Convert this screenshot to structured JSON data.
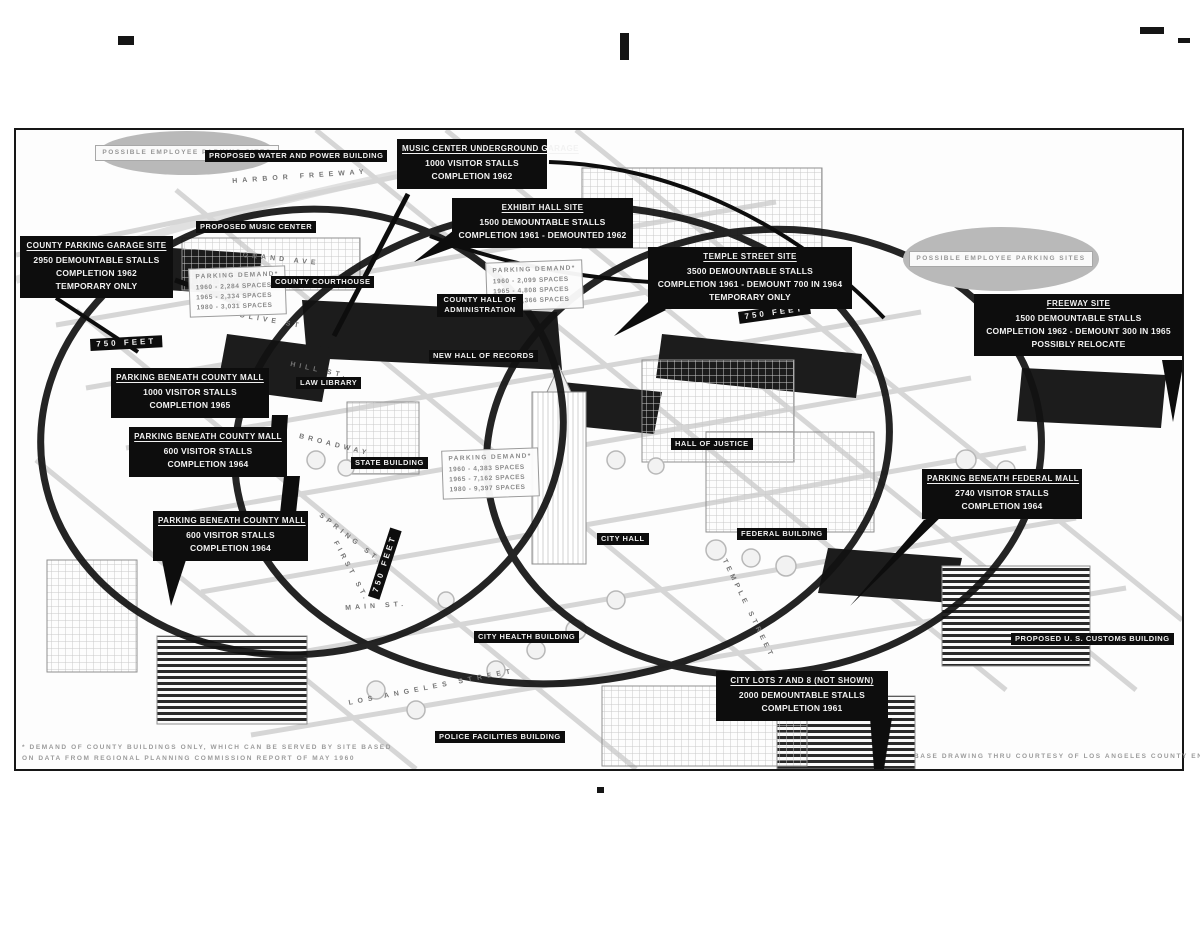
{
  "callouts": [
    {
      "id": "music-center-garage",
      "title": "MUSIC CENTER UNDERGROUND GARAGE",
      "line1": "1000 VISITOR STALLS",
      "line2": "COMPLETION 1962"
    },
    {
      "id": "exhibit-hall",
      "title": "EXHIBIT HALL SITE",
      "line1": "1500 DEMOUNTABLE STALLS",
      "line2": "COMPLETION 1961 - DEMOUNTED 1962"
    },
    {
      "id": "county-parking-garage",
      "title": "COUNTY PARKING GARAGE SITE",
      "line1": "2950 DEMOUNTABLE STALLS",
      "line2": "COMPLETION 1962",
      "line3": "TEMPORARY ONLY"
    },
    {
      "id": "temple-street-site",
      "title": "TEMPLE STREET SITE",
      "line1": "3500 DEMOUNTABLE STALLS",
      "line2": "COMPLETION 1961 - DEMOUNT 700 IN 1964",
      "line3": "TEMPORARY ONLY"
    },
    {
      "id": "freeway-site",
      "title": "FREEWAY SITE",
      "line1": "1500 DEMOUNTABLE STALLS",
      "line2": "COMPLETION 1962 - DEMOUNT 300 IN 1965",
      "line3": "POSSIBLY RELOCATE"
    },
    {
      "id": "county-mall-north",
      "title": "PARKING BENEATH COUNTY MALL",
      "line1": "1000 VISITOR STALLS",
      "line2": "COMPLETION 1965"
    },
    {
      "id": "county-mall-center",
      "title": "PARKING BENEATH COUNTY MALL",
      "line1": "600 VISITOR STALLS",
      "line2": "COMPLETION 1964"
    },
    {
      "id": "county-mall-south",
      "title": "PARKING BENEATH COUNTY MALL",
      "line1": "600 VISITOR STALLS",
      "line2": "COMPLETION 1964"
    },
    {
      "id": "federal-mall",
      "title": "PARKING BENEATH FEDERAL MALL",
      "line1": "2740 VISITOR STALLS",
      "line2": "COMPLETION 1964"
    },
    {
      "id": "city-lots-7-8",
      "title": "CITY LOTS 7 AND 8  (NOT SHOWN)",
      "line1": "2000 DEMOUNTABLE STALLS",
      "line2": "COMPLETION 1961"
    }
  ],
  "building_labels": [
    "PROPOSED WATER AND POWER BUILDING",
    "PROPOSED MUSIC CENTER",
    "COUNTY COURTHOUSE",
    "COUNTY HALL OF ADMINISTRATION",
    "NEW HALL OF RECORDS",
    "LAW LIBRARY",
    "HALL OF JUSTICE",
    "STATE BUILDING",
    "CITY HALL",
    "FEDERAL BUILDING",
    "CITY HEALTH BUILDING",
    "POLICE FACILITIES BUILDING",
    "PROPOSED U. S. CUSTOMS BUILDING"
  ],
  "street_labels": [
    "HARBOR  FREEWAY",
    "GRAND  AVE",
    "OLIVE  ST",
    "HILL  ST.",
    "BROADWAY",
    "SPRING  ST.",
    "FIRST  ST.",
    "MAIN  ST.",
    "LOS  ANGELES  STREET",
    "TEMPLE  STREET"
  ],
  "distance_labels": [
    "750  FEET",
    "750  FEET",
    "750  FEET"
  ],
  "employee_parking": {
    "left_line1": "POSSIBLE  EMPLOYEE",
    "left_line2": "PARKING  SITES",
    "right_label": "POSSIBLE  EMPLOYEE  PARKING  SITES"
  },
  "demand_tables": [
    {
      "header": "PARKING  DEMAND*",
      "rows": [
        "1960 - 2,284  SPACES",
        "1965 - 2,334  SPACES",
        "1980 - 3,031  SPACES"
      ]
    },
    {
      "header": "PARKING  DEMAND*",
      "rows": [
        "1960 - 2,099  SPACES",
        "1965 - 4,808  SPACES",
        "1980 - 6,366  SPACES"
      ]
    },
    {
      "header": "PARKING  DEMAND*",
      "rows": [
        "1960 - 4,383  SPACES",
        "1965 - 7,162  SPACES",
        "1980 - 9,397  SPACES"
      ]
    }
  ],
  "footnotes": {
    "left_line1": "* DEMAND OF COUNTY BUILDINGS ONLY, WHICH CAN BE SERVED BY SITE BASED",
    "left_line2": "ON DATA FROM REGIONAL PLANNING COMMISSION REPORT OF MAY 1960",
    "right": "BASE DRAWING THRU COURTESY OF LOS ANGELES COUNTY ENGINEERS' OFFICE"
  },
  "colors": {
    "callout_bg": "#0d0d0d",
    "callout_text": "#f2f2f2",
    "ring": "#121212",
    "paper": "#fdfdfd",
    "blob_gray": "#b9b9b9"
  }
}
